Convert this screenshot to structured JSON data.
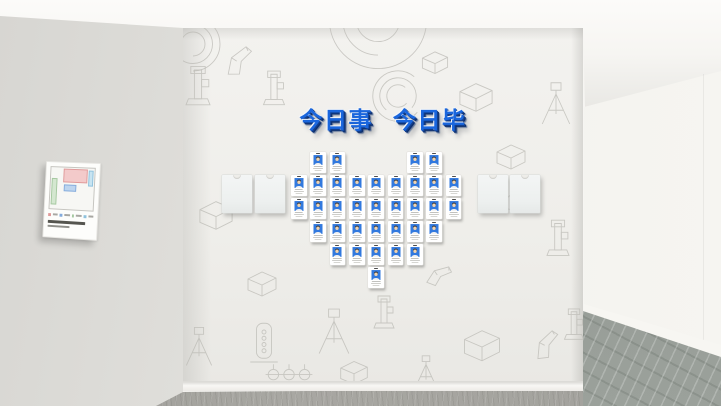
{
  "scene": {
    "type": "3d-render-exhibition-wall",
    "description": "Office culture wall with employee badge heart and equipment line-art wallpaper"
  },
  "slogan": {
    "text": "今日事 今日毕",
    "color": "#1a66dd",
    "shadow_color": "#0d2f6d"
  },
  "badge_wall": {
    "layout": "heart",
    "badge_count": 35,
    "portrait_bg_color": "#3279de",
    "grid": {
      "origin_x": 291,
      "origin_y": 152,
      "col_step": 19.35,
      "row_step": 23
    },
    "rows": [
      {
        "cols": [
          1,
          2,
          6,
          7
        ]
      },
      {
        "cols": [
          0,
          1,
          2,
          3,
          4,
          5,
          6,
          7,
          8
        ]
      },
      {
        "cols": [
          0,
          1,
          2,
          3,
          4,
          5,
          6,
          7,
          8
        ]
      },
      {
        "cols": [
          1,
          2,
          3,
          4,
          5,
          6,
          7
        ]
      },
      {
        "cols": [
          2,
          3,
          4,
          5,
          6
        ]
      },
      {
        "cols": [
          4
        ]
      }
    ]
  },
  "card_pockets": {
    "count": 4,
    "positions_x": [
      222,
      255,
      478,
      510
    ],
    "y": 175
  },
  "floor_plan_poster": {
    "regions": [
      {
        "name": "pink-area",
        "fill": "#f3caca",
        "stroke": "#e09a9a",
        "x": 28,
        "y": 2,
        "w": 56,
        "h": 34
      },
      {
        "name": "cyan-strip",
        "fill": "#c8e4f1",
        "stroke": "#8fc2dd",
        "x": 86,
        "y": 4,
        "w": 12,
        "h": 40
      },
      {
        "name": "blue-room",
        "fill": "#bdd5ef",
        "stroke": "#84abdc",
        "x": 30,
        "y": 40,
        "w": 30,
        "h": 16
      },
      {
        "name": "green-strip",
        "fill": "#d4e7d0",
        "stroke": "#a5c8a0",
        "x": 2,
        "y": 26,
        "w": 14,
        "h": 64
      }
    ],
    "legend_colors": [
      "#e09a9a",
      "#84abdc",
      "#a5c8a0",
      "#8fc2dd"
    ]
  },
  "wall_sketches": [
    {
      "type": "arcs",
      "x": 378,
      "y": 20,
      "s": 2.7,
      "r": 0
    },
    {
      "type": "arcs",
      "x": 398,
      "y": 96,
      "s": 1.4,
      "r": 40
    },
    {
      "type": "arcs",
      "x": 193,
      "y": 44,
      "s": 1.5,
      "r": 180
    },
    {
      "type": "scanner",
      "x": 238,
      "y": 62,
      "s": 1.1,
      "r": -12
    },
    {
      "type": "column",
      "x": 198,
      "y": 88,
      "s": 1.2,
      "r": 0
    },
    {
      "type": "column",
      "x": 274,
      "y": 90,
      "s": 1.05,
      "r": 0
    },
    {
      "type": "box",
      "x": 216,
      "y": 212,
      "s": 1.15,
      "r": 0
    },
    {
      "type": "box",
      "x": 476,
      "y": 94,
      "s": 1.15,
      "r": 0
    },
    {
      "type": "box",
      "x": 511,
      "y": 154,
      "s": 1.0,
      "r": 0
    },
    {
      "type": "tripod",
      "x": 556,
      "y": 104,
      "s": 1.25,
      "r": 0
    },
    {
      "type": "column",
      "x": 558,
      "y": 240,
      "s": 1.1,
      "r": 0
    },
    {
      "type": "scanner",
      "x": 514,
      "y": 200,
      "s": 0.95,
      "r": 14
    },
    {
      "type": "box",
      "x": 262,
      "y": 281,
      "s": 1.0,
      "r": 0
    },
    {
      "type": "cylinder",
      "x": 264,
      "y": 342,
      "s": 1.25,
      "r": 0
    },
    {
      "type": "tripod",
      "x": 334,
      "y": 332,
      "s": 1.35,
      "r": 0
    },
    {
      "type": "column",
      "x": 384,
      "y": 314,
      "s": 1.0,
      "r": 0
    },
    {
      "type": "box",
      "x": 482,
      "y": 342,
      "s": 1.25,
      "r": 0
    },
    {
      "type": "scanner",
      "x": 546,
      "y": 346,
      "s": 1.05,
      "r": -18
    },
    {
      "type": "tripod",
      "x": 199,
      "y": 347,
      "s": 1.15,
      "r": 0
    },
    {
      "type": "rack",
      "x": 289,
      "y": 372,
      "s": 1.3,
      "r": 0
    },
    {
      "type": "box",
      "x": 354,
      "y": 370,
      "s": 0.95,
      "r": 0
    },
    {
      "type": "tripod",
      "x": 426,
      "y": 372,
      "s": 0.95,
      "r": 0
    },
    {
      "type": "column",
      "x": 574,
      "y": 326,
      "s": 0.95,
      "r": 0
    },
    {
      "type": "scanner",
      "x": 438,
      "y": 276,
      "s": 0.9,
      "r": 10
    },
    {
      "type": "box",
      "x": 435,
      "y": 60,
      "s": 0.9,
      "r": 0
    }
  ]
}
